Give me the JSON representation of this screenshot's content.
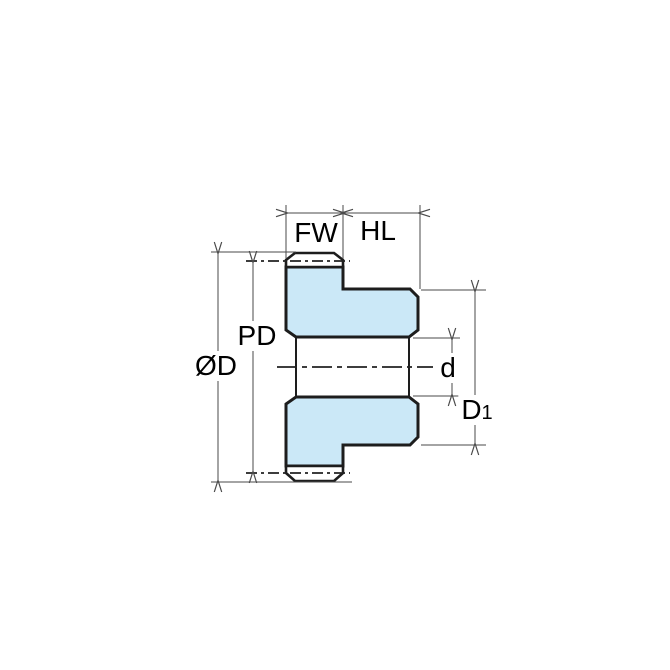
{
  "diagram": {
    "labels": {
      "face_width": "FW",
      "hub_length": "HL",
      "pitch_diameter": "PD",
      "outer_diameter": "ØD",
      "bore_diameter": "d",
      "hub_diameter": {
        "text": "D",
        "subscript": "1"
      }
    },
    "colors": {
      "gear_fill": "#cbe8f7",
      "outline": "#1d1d1d",
      "dim_line": "#4a4a4a",
      "text": "#000000",
      "bg": "#ffffff"
    }
  }
}
